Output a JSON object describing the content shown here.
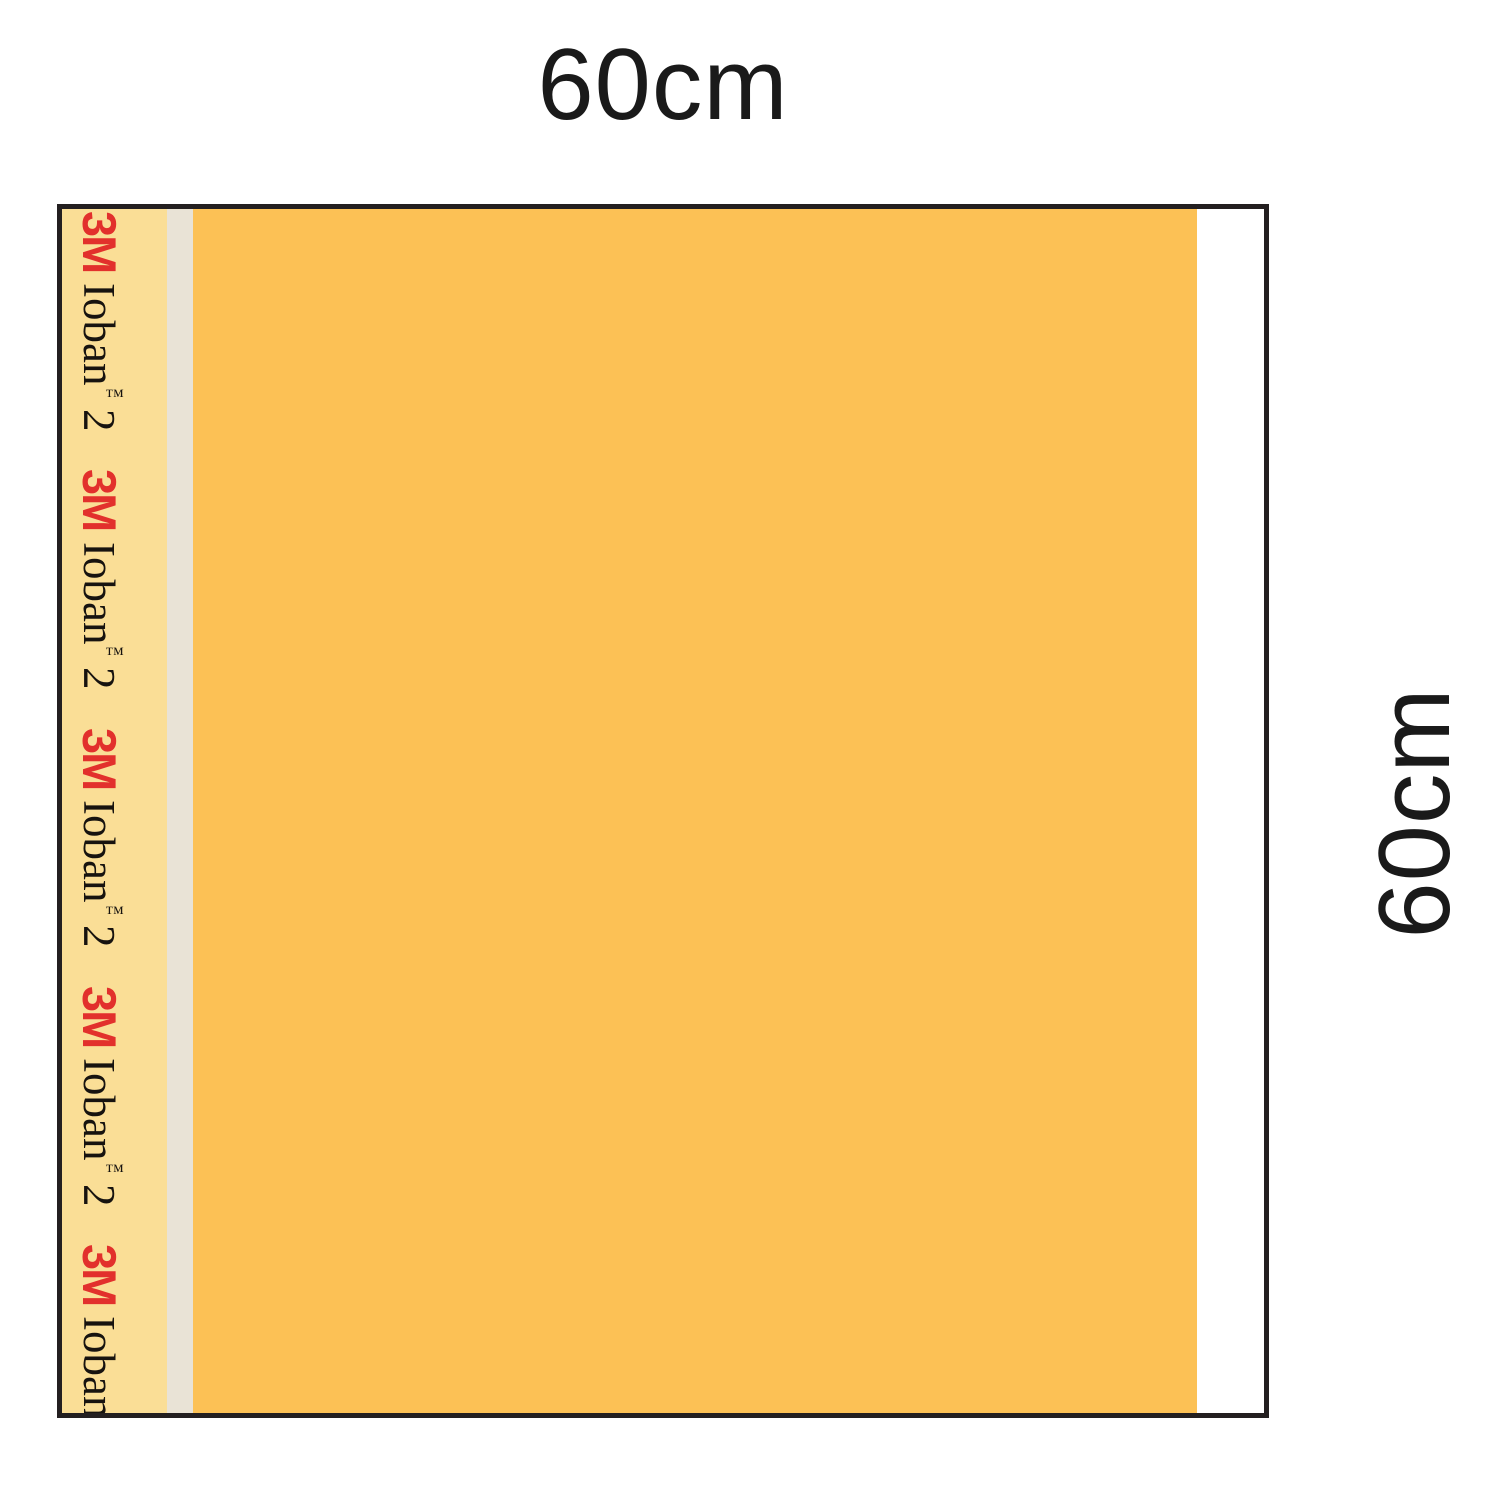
{
  "diagram": {
    "description": "surgical incise drape size diagram",
    "dimensions": {
      "top_label": "60cm",
      "side_label": "60cm"
    },
    "drape": {
      "brand": "3M",
      "product": "Ioban",
      "trademark": "™",
      "version": "2",
      "edge_label_repeat": 5
    },
    "colors": {
      "film_orange": "#FCC155",
      "paper_strip_yellow": "#FADE96",
      "divider_beige": "#E9E3D6",
      "handle_white": "#FFFFFF",
      "outline_black": "#231F20",
      "brand_red": "#E2302C",
      "label_text": "#1A1A1A",
      "background": "#FFFFFF"
    }
  }
}
